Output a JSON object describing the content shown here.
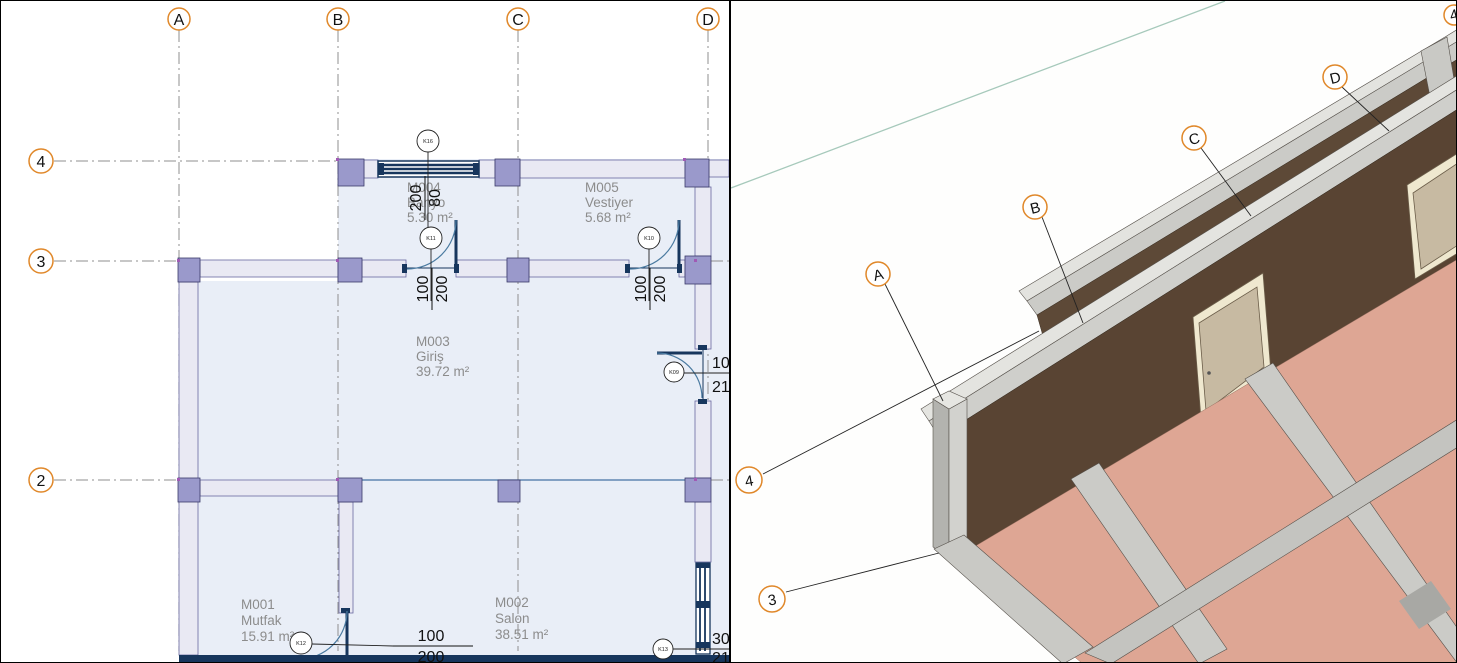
{
  "app": {
    "description": "BIM floor plan and 3D structural view, split panes"
  },
  "plan": {
    "grids": {
      "letters": [
        "A",
        "B",
        "C",
        "D"
      ],
      "numbers": [
        "4",
        "3",
        "2"
      ]
    },
    "rooms": [
      {
        "id": "M001",
        "name": "Mutfak",
        "area": "15.91 m²"
      },
      {
        "id": "M002",
        "name": "Salon",
        "area": "38.51 m²"
      },
      {
        "id": "M003",
        "name": "Giriş",
        "area": "39.72 m²"
      },
      {
        "id": "M004",
        "name": "Banyo",
        "area": "5.30 m²"
      },
      {
        "id": "M005",
        "name": "Vestiyer",
        "area": "5.68 m²"
      }
    ],
    "tags": [
      {
        "id": "K16",
        "w": "200",
        "h": "80"
      },
      {
        "id": "K11",
        "w": "100",
        "h": "200"
      },
      {
        "id": "K10",
        "w": "100",
        "h": "200"
      },
      {
        "id": "K09",
        "w": "10",
        "h": "21"
      },
      {
        "id": "K12",
        "w": "100",
        "h": "200"
      },
      {
        "id": "K13",
        "w": "30",
        "h": "21"
      }
    ]
  },
  "view3d": {
    "bubbles": [
      "A",
      "B",
      "C",
      "D",
      "4",
      "3",
      "4"
    ]
  },
  "colors": {
    "grid_bubble": "#e0882a",
    "room_fill": "#e9eef7",
    "wall_fill": "#e9e9f3",
    "column_fill": "#9a99cb",
    "window_navy": "#17365d",
    "room_label": "#8c8c8c",
    "floor_3d": "#dea694",
    "wall_3d": "#594433",
    "beam_3d": "#cbcbc7",
    "glass_3d": "#b7d7d3",
    "door_3d": "#c7baa2",
    "green_line": "#a6c9bb"
  }
}
